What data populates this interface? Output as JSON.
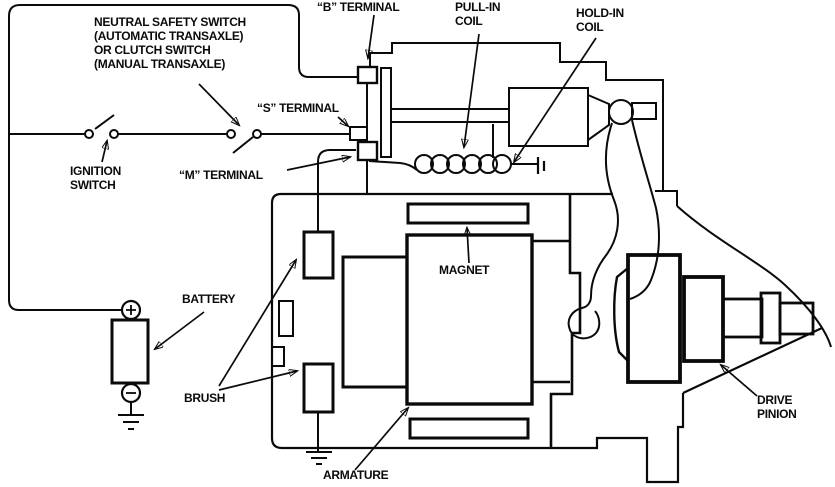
{
  "diagram": {
    "description": "Starter motor and solenoid control circuit diagram",
    "colors": {
      "ink": "#0a0a0a",
      "background": "#ffffff"
    },
    "labels": {
      "neutral_safety_switch": "NEUTRAL SAFETY SWITCH\n(AUTOMATIC TRANSAXLE)\nOR CLUTCH SWITCH\n(MANUAL TRANSAXLE)",
      "b_terminal": "“B” TERMINAL",
      "pull_in_coil": "PULL-IN\nCOIL",
      "hold_in_coil": "HOLD-IN\nCOIL",
      "s_terminal": "“S” TERMINAL",
      "m_terminal": "“M” TERMINAL",
      "ignition_switch": "IGNITION\nSWITCH",
      "battery": "BATTERY",
      "brush": "BRUSH",
      "magnet": "MAGNET",
      "armature": "ARMATURE",
      "drive_pinion": "DRIVE\nPINION"
    }
  }
}
